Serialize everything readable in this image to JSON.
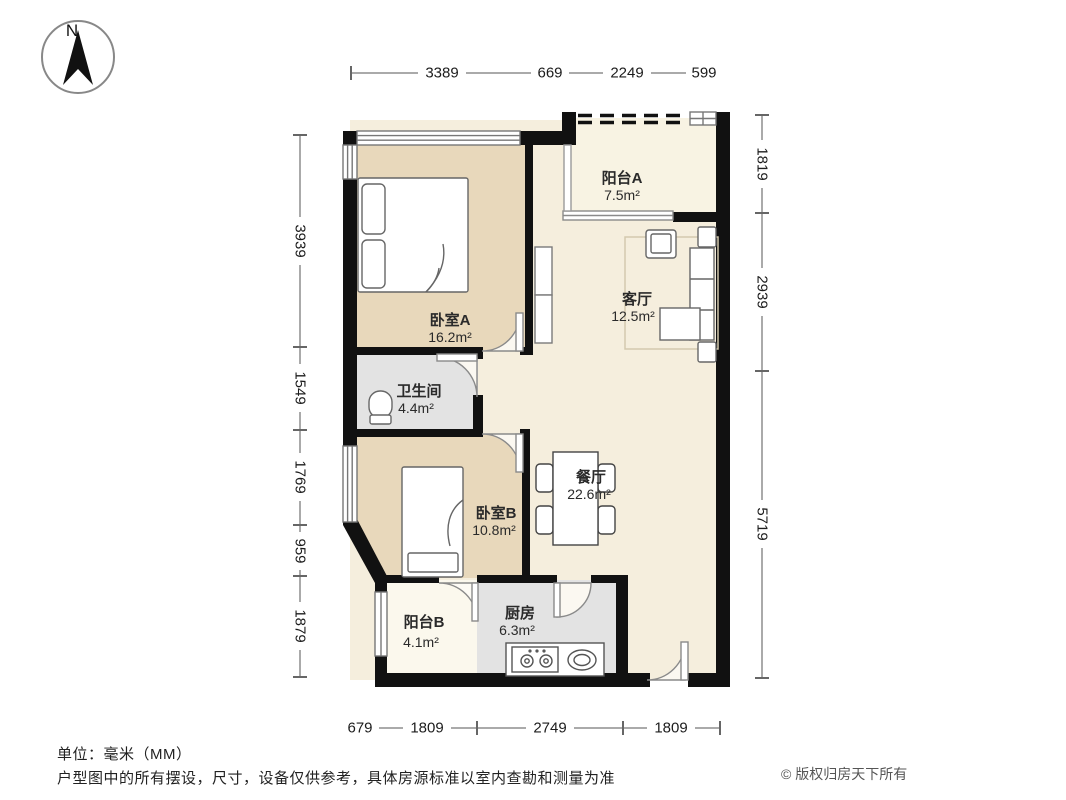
{
  "compass": {
    "label": "N"
  },
  "rooms": {
    "balcony_a": {
      "name": "阳台A",
      "area": "7.5m²"
    },
    "living": {
      "name": "客厅",
      "area": "12.5m²"
    },
    "bedroom_a": {
      "name": "卧室A",
      "area": "16.2m²"
    },
    "bathroom": {
      "name": "卫生间",
      "area": "4.4m²"
    },
    "bedroom_b": {
      "name": "卧室B",
      "area": "10.8m²"
    },
    "dining": {
      "name": "餐厅",
      "area": "22.6m²"
    },
    "balcony_b": {
      "name": "阳台B",
      "area": "4.1m²"
    },
    "kitchen": {
      "name": "厨房",
      "area": "6.3m²"
    }
  },
  "dimensions": {
    "top": [
      "3389",
      "669",
      "2249",
      "599"
    ],
    "right": [
      "1819",
      "2939",
      "5719"
    ],
    "left": [
      "3939",
      "1549",
      "1769",
      "959",
      "1879"
    ],
    "bottom": [
      "679",
      "1809",
      "2749",
      "1809"
    ]
  },
  "footer": {
    "unit": "单位：毫米（MM）",
    "disclaimer": "户型图中的所有摆设，尺寸，设备仅供参考，具体房源标准以室内查勘和测量为准",
    "copyright": "© 版权归房天下所有"
  },
  "colors": {
    "wall": "#111111",
    "bedroom_floor": "#e8d8bb",
    "living_floor": "#f5eedd",
    "balcony_a_floor": "#f8f3e3",
    "balcony_b_floor": "#fbf8ed",
    "service_floor": "#e3e3e3"
  }
}
